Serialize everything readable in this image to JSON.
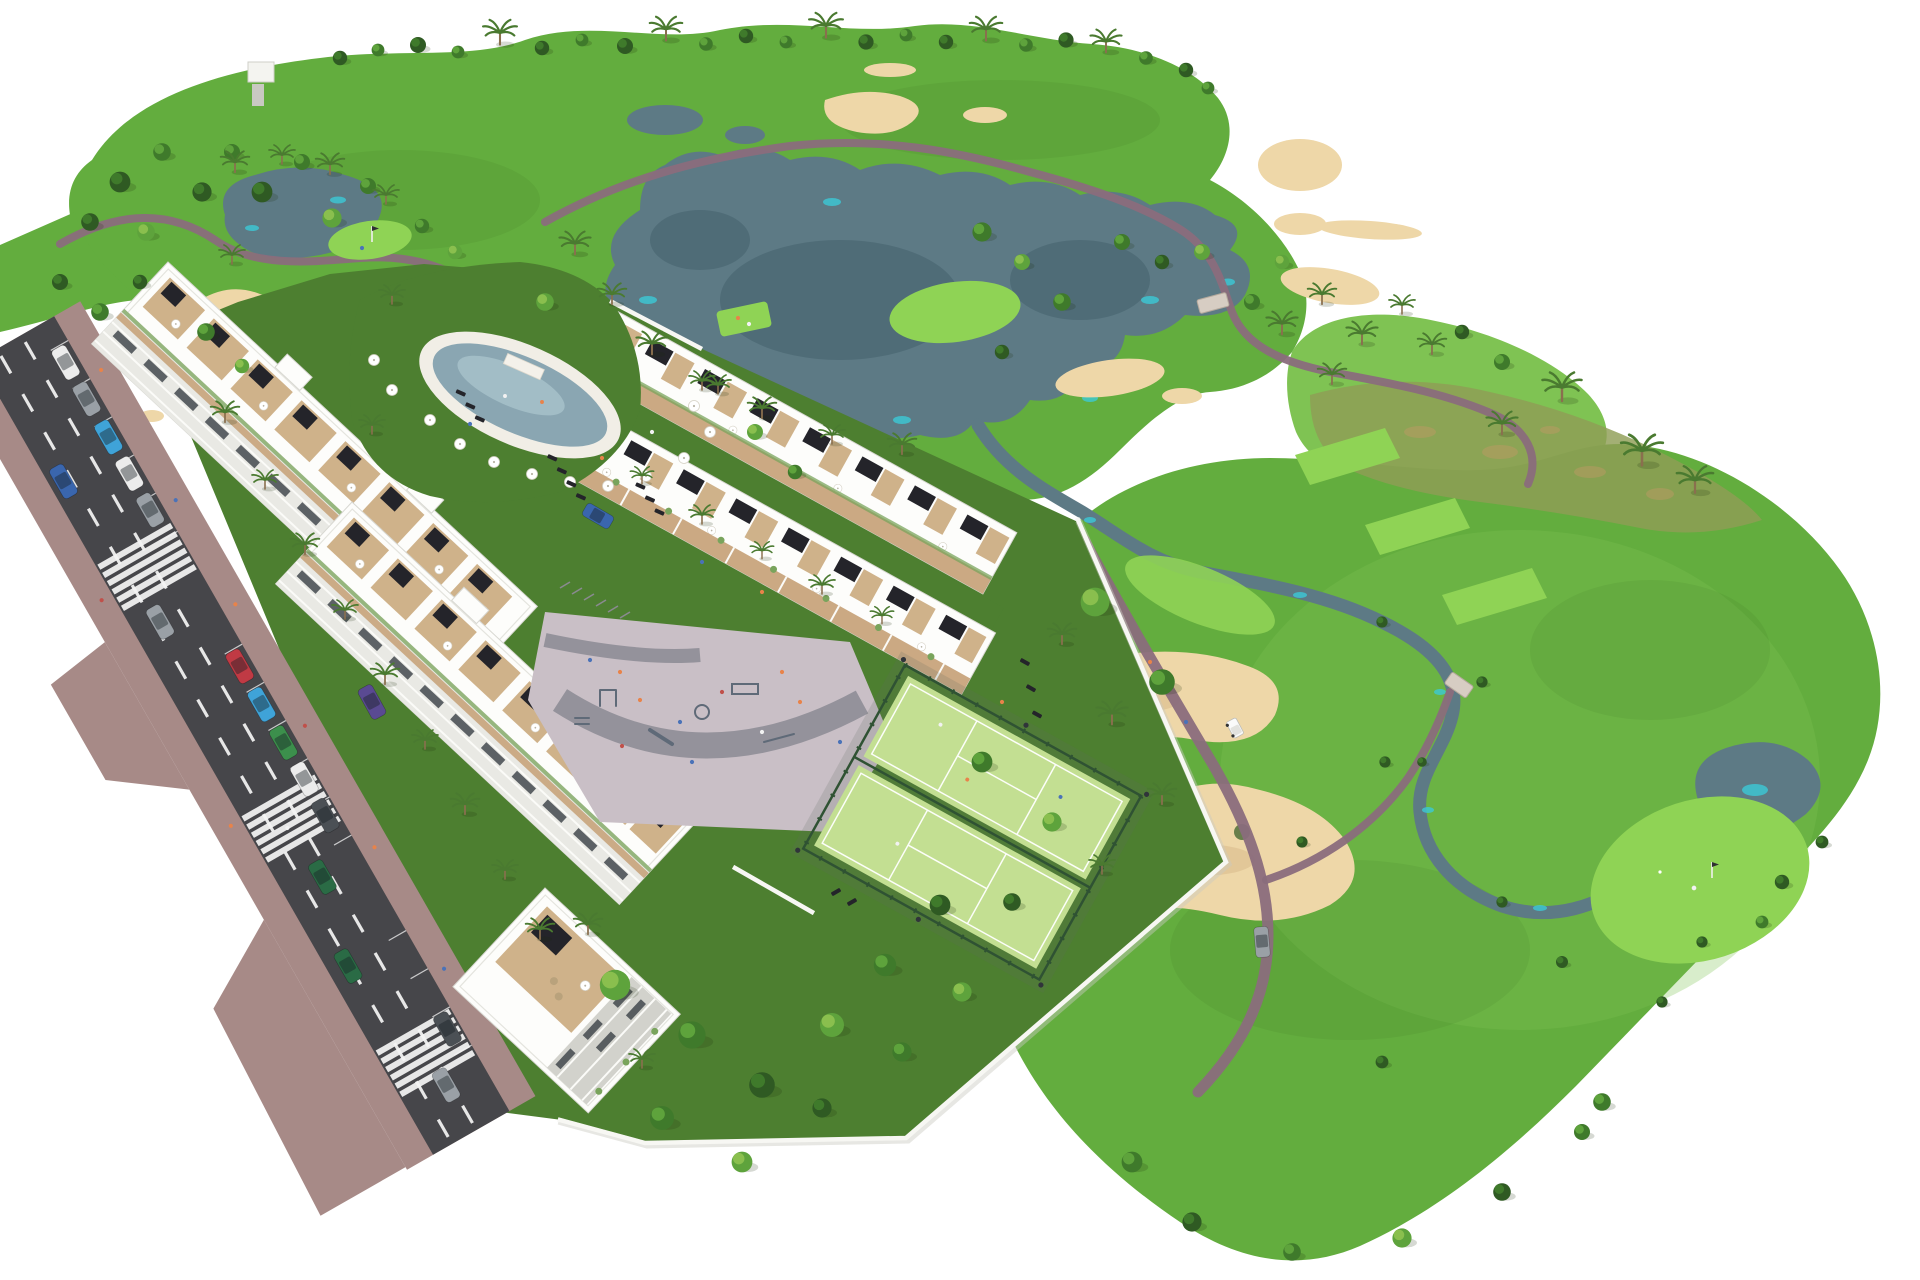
{
  "scene": {
    "description": "3D aerial rendering of a white residential apartment and townhouse complex with resort amenities, beside a golf course with lakes, sand bunkers and cart paths, bounded by a street in the foreground on a white background"
  },
  "palette": {
    "bg": "#ffffff",
    "grass": "#63ad3e",
    "grassLight": "#7fc353",
    "grassDark": "#4d7f30",
    "tee": "#8fd355",
    "scrub": "#8f9e55",
    "dirt": "#c09a66",
    "sand": "#eed7a8",
    "sandShadow": "#d9ba8a",
    "water": "#5d7a85",
    "waterDeep": "#44606c",
    "waterAccent": "#3cc9d6",
    "path": "#8a6d7c",
    "sidewalk": "#a78a87",
    "asphalt": "#46464a",
    "laneMark": "#f5f5f5",
    "wall": "#f7f7f3",
    "bldg": "#fdfdfb",
    "bldgShade": "#e9e9e4",
    "facadeShade": "#d2d2cc",
    "glass": "#3a4046",
    "wood": "#c5a076",
    "terrace": "#cfb28a",
    "pergola": "#24242a",
    "greenRoof": "#79a45c",
    "poolDeck": "#f1eee6",
    "poolWater": "#8aa6b2",
    "poolWaterLight": "#b3cdd4",
    "court": "#c3df92",
    "courtLine": "#ffffff",
    "fence": "#2f5233",
    "paving": "#c9bfc6",
    "pavingPath": "#8e8d96",
    "equip": "#5f6a78",
    "treeDark": "#2f5a23",
    "treeMid": "#3f7a2b",
    "treeLight": "#5ea33c",
    "treeYellow": "#8abf4e",
    "palm": "#4a7a30",
    "trunk": "#8a6f4e",
    "carWhite": "#ececec",
    "carGray": "#9aa0a6",
    "carDark": "#4b5055",
    "carBlue": "#3a66ae",
    "carLightBlue": "#3fa3d8",
    "carRed": "#c03a44",
    "carGreen": "#3c8f4c",
    "carDarkGreen": "#2a6b45",
    "carPurple": "#5a4a92",
    "person": "#e8834a",
    "personAlt": "#4a72b8",
    "personWhite": "#f2f2f2"
  },
  "features": {
    "golf_course": {
      "lakes": 3,
      "streams": 1,
      "bunker_clusters": 8,
      "putting_greens_with_flag": 3,
      "tee_boxes": 4,
      "cart_paths": true,
      "golf_cart": true,
      "golfers": 3,
      "footbridges": 2
    },
    "residential": {
      "apartment_blocks": 3,
      "townhouse_rows": 2,
      "swimming_pool": 1,
      "pool_umbrellas": 12,
      "padel_courts": 2,
      "playground": true,
      "outdoor_gym": true,
      "bike_racks": true,
      "rooftop_terraces": true,
      "perimeter_wall": true
    },
    "street": {
      "traffic_lanes": 3,
      "crosswalks": 3,
      "cars": 16,
      "street_palms": 9,
      "pedestrians": true
    }
  }
}
